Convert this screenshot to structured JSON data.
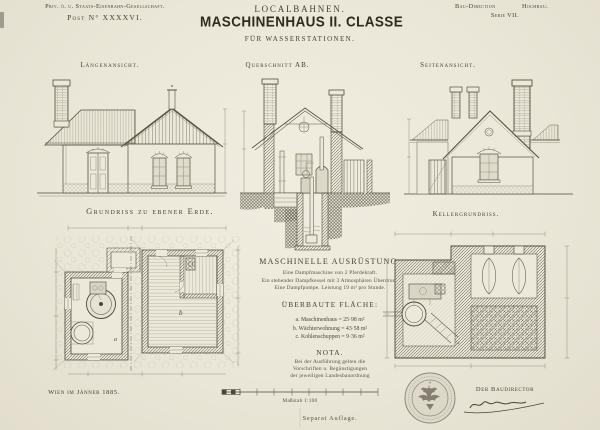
{
  "colors": {
    "paper": "#ebe7d8",
    "ink": "#45402f",
    "line": "#4c473a"
  },
  "header": {
    "company": "Priv. ö. u. Staats-Eisenbahn-Gesellschaft.",
    "post_number": "Post N° XXXXVI.",
    "series_title": "LOCALBAHNEN.",
    "main_title": "MASCHINENHAUS II. CLASSE",
    "subtitle": "FÜR WASSERSTATIONEN.",
    "department": "Bau-Direction",
    "division": "Hochbau.",
    "series": "Serie VII."
  },
  "view_titles": {
    "front_elevation": "Längenansicht.",
    "cross_section": "Querschnitt AB.",
    "side_elevation": "Seitenansicht.",
    "ground_floor_plan": "Grundriss zu ebener Erde.",
    "basement_plan": "Kellergrundriss."
  },
  "plan_labels": {
    "machine_room": "a",
    "dwelling_room": "b"
  },
  "equipment": {
    "title": "MASCHINELLE AUSRÜSTUNG.",
    "items": [
      "Eine Dampfmaschine von 2 Pferdekraft.",
      "Ein stehender Dampfkessel mit 3 Atmosphären Überdruck",
      "Eine Dampfpumpe. Leistung 19 m³ pro Stunde."
    ],
    "built_area_title": "ÜBERBAUTE FLÄCHE:",
    "built_areas": [
      {
        "label": "a. Maschinenhaus",
        "value": "= 25·98 m²"
      },
      {
        "label": "b. Wächterwohnung",
        "value": "= 43·58 m²"
      },
      {
        "label": "c. Kohlenschuppen",
        "value": "= 9·36 m²"
      }
    ],
    "nota_title": "NOTA.",
    "nota_lines": [
      "Bei der Ausführung gelten die",
      "Vorschriften u. Begünstigungen",
      "der jeweiligen Landesbauordnung"
    ]
  },
  "footer": {
    "place_date": "Wien im Jänner 1885.",
    "scale": "Maßstab 1:100",
    "edition": "Separat Auflage.",
    "signature_title": "Der Baudirector"
  }
}
